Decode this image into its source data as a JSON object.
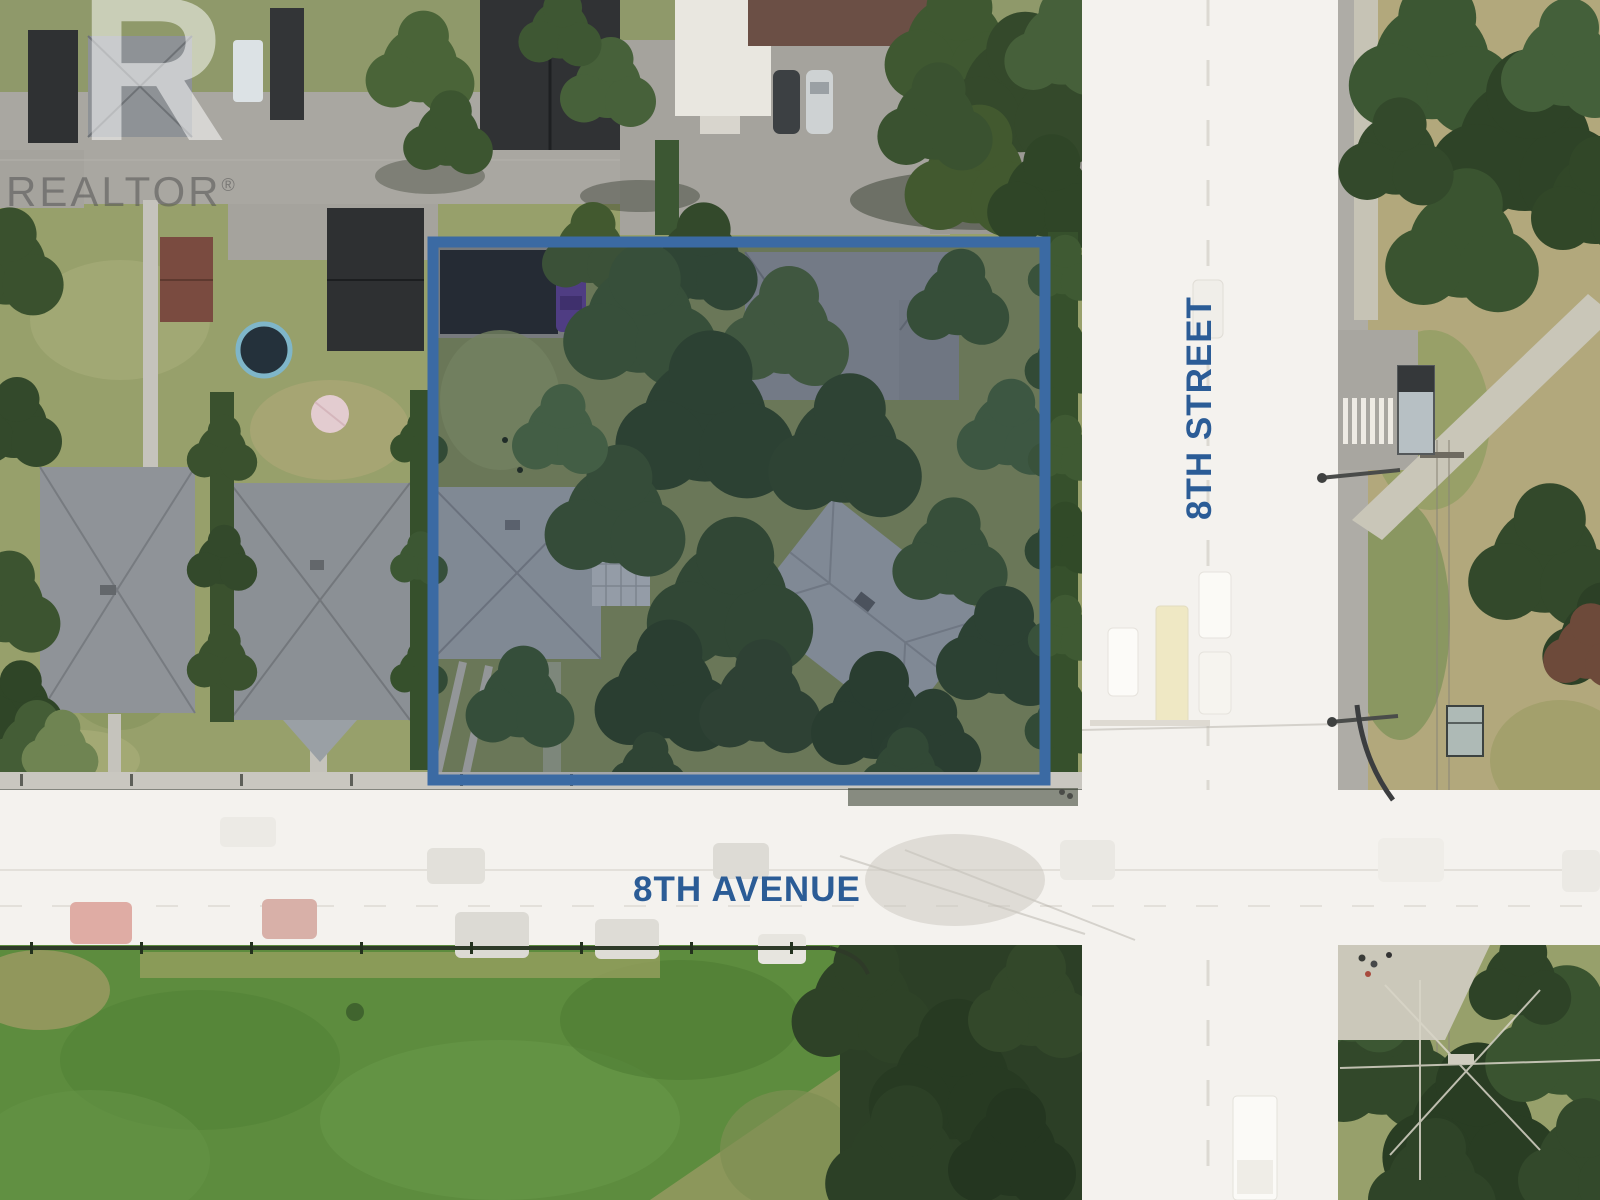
{
  "meta": {
    "type": "aerial-property-listing-photo",
    "description": "Aerial drone photo of a corner land assembly outlined in blue at 8th Street and 8th Avenue"
  },
  "watermark": {
    "logo_letter": "R",
    "brand": "REALTOR",
    "registered_mark": "®"
  },
  "labels": {
    "street_vertical": "8TH STREET",
    "street_horizontal": "8TH AVENUE"
  },
  "colors": {
    "label_blue": "#2b5c96",
    "boundary_blue": "#3b6aa3",
    "boundary_tint": "rgba(36,56,90,0.22)",
    "road_overlay": "#f4f2ee",
    "pavement_gray": "#a9a7a1",
    "field_green": "#5d8c3e",
    "lawn_olive": "#97a06b",
    "tree_green": "#3a5230",
    "roof_gray": "#8f9398",
    "roof_dark": "#2f3133",
    "shed_red": "#7a4b40",
    "car_purple": "#5b3f8f",
    "trampoline_blue": "#7fb6c9"
  }
}
